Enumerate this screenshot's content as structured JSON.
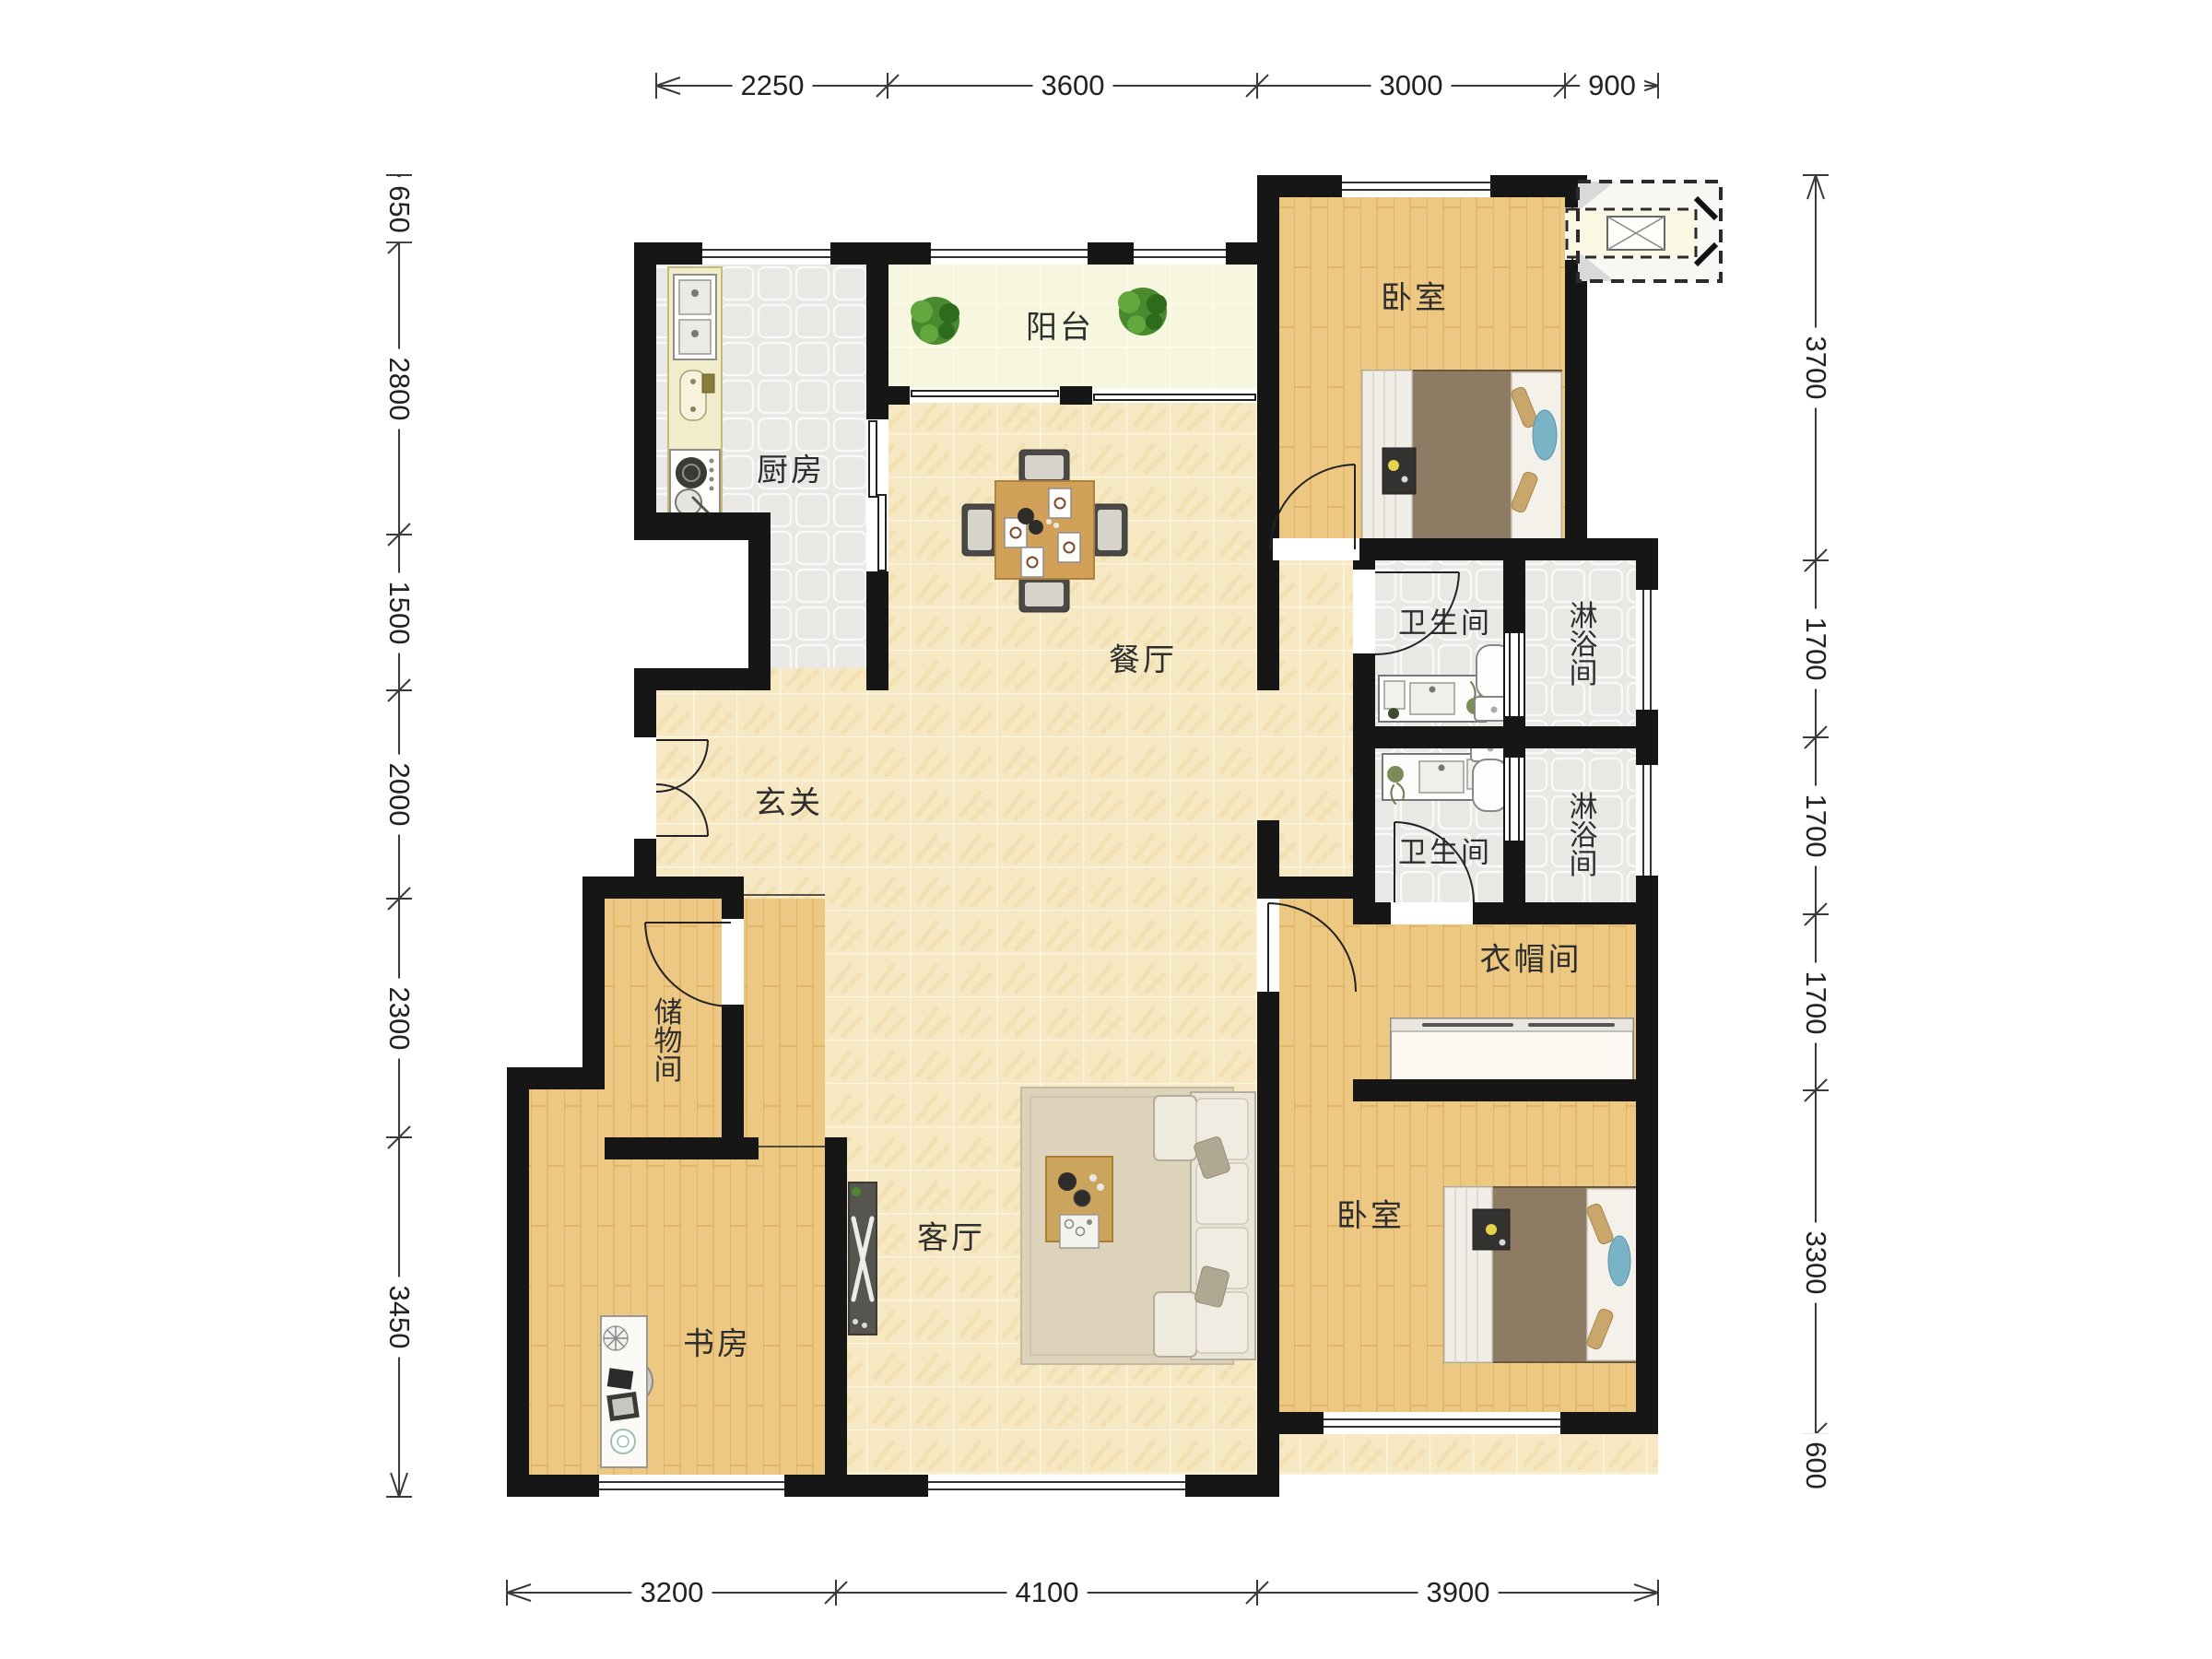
{
  "plan": {
    "type": "apartment-floor-plan",
    "rooms": {
      "kitchen": "厨房",
      "balcony": "阳台",
      "dining": "餐厅",
      "entry": "玄关",
      "storage": "储物间",
      "study": "书房",
      "living": "客厅",
      "bedroom_top": "卧室",
      "bedroom_bottom": "卧室",
      "bath1": "卫生间",
      "bath2": "卫生间",
      "shower1": "淋浴间",
      "shower2": "淋浴间",
      "cloakroom": "衣帽间"
    },
    "dimensions": {
      "top": [
        "2250",
        "3600",
        "3000",
        "900"
      ],
      "left": [
        "650",
        "2800",
        "1500",
        "2000",
        "2300",
        "3450"
      ],
      "right": [
        "3700",
        "1700",
        "1700",
        "1700",
        "3300",
        "600"
      ],
      "bottom": [
        "3200",
        "4100",
        "3900"
      ]
    },
    "colors": {
      "wall": "#161616",
      "tile_floor": "#f6e8c3",
      "wood_floor": "#ecc883",
      "gray_floor": "#e9e8e5",
      "balcony_floor": "#f7f7e0",
      "dim_line": "#3a3a3a",
      "plant": "#4a8a2e",
      "bed_frame": "#8d7b64",
      "accent_blue": "#7ab3c6"
    }
  }
}
